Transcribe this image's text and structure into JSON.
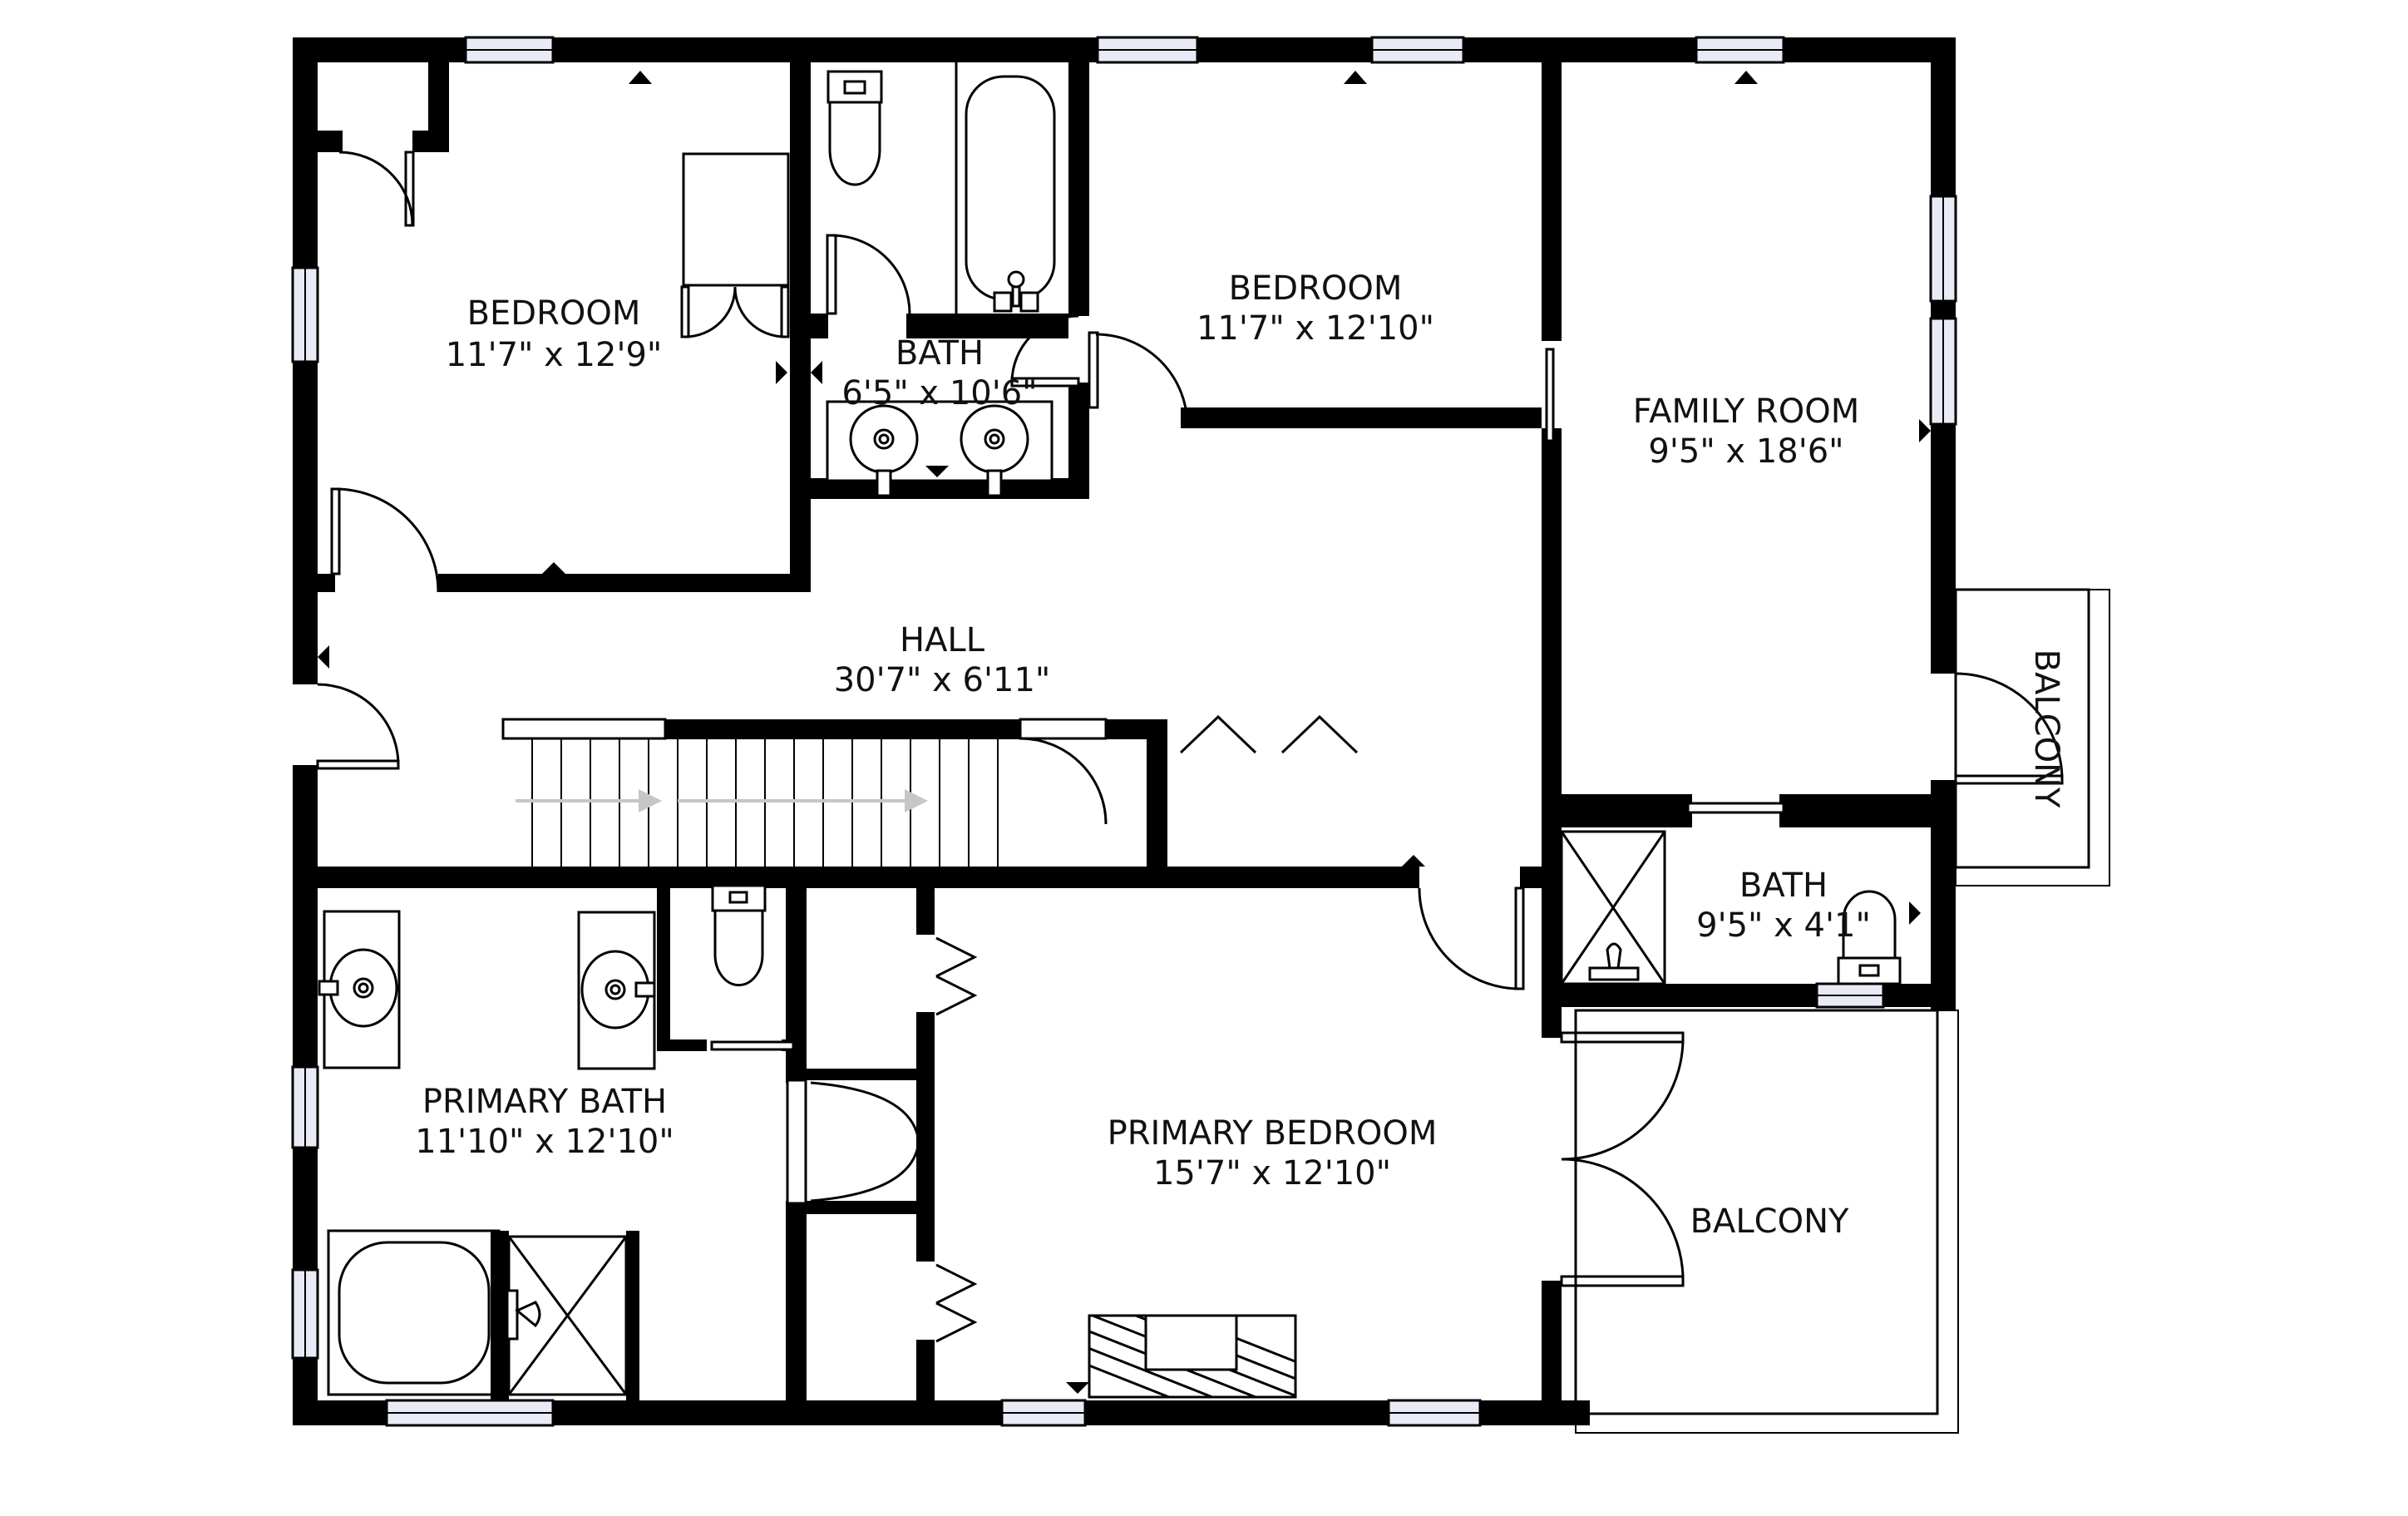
{
  "plan": {
    "title": "Second Floor Plan",
    "colors": {
      "wall": "#000000",
      "window_fill": "#e8eaf6",
      "background": "#ffffff",
      "stair_arrow": "#c6c6c6",
      "text": "#111111"
    },
    "rooms": [
      {
        "name": "BEDROOM",
        "dims": "11'7\" x 12'9\""
      },
      {
        "name": "BATH",
        "dims": "6'5\" x 10'6\""
      },
      {
        "name": "BEDROOM",
        "dims": "11'7\" x 12'10\""
      },
      {
        "name": "FAMILY ROOM",
        "dims": "9'5\" x 18'6\""
      },
      {
        "name": "HALL",
        "dims": "30'7\" x 6'11\""
      },
      {
        "name": "BATH",
        "dims": "9'5\" x 4'1\""
      },
      {
        "name": "PRIMARY BATH",
        "dims": "11'10\" x 12'10\""
      },
      {
        "name": "PRIMARY BEDROOM",
        "dims": "15'7\" x 12'10\""
      },
      {
        "name": "BALCONY",
        "dims": ""
      },
      {
        "name": "BALCONY",
        "dims": ""
      }
    ],
    "fixtures": [
      "toilet",
      "bathtub",
      "double-vanity-sinks",
      "stairs-up-arrows",
      "shower-with-glass",
      "primary-soaking-tub",
      "primary-shower",
      "two-vanity-sinks",
      "water-closet-toilet",
      "fireplace",
      "french-doors-to-balcony",
      "pocket-doors",
      "bifold-closet-doors",
      "windows"
    ]
  }
}
